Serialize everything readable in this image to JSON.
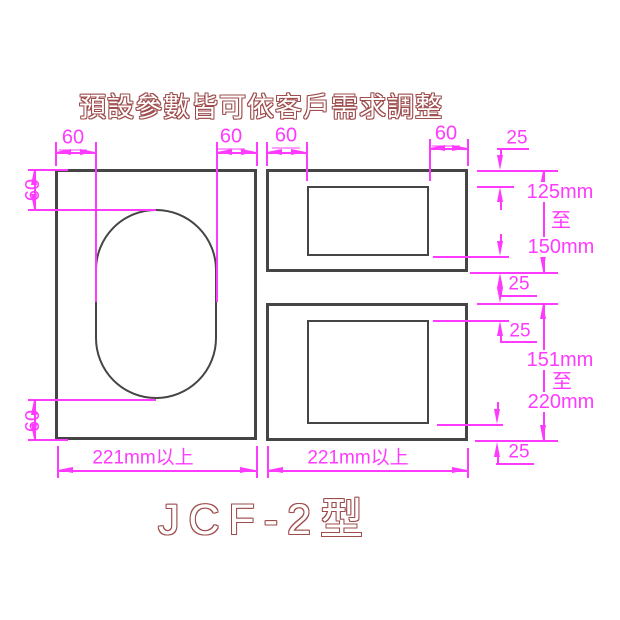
{
  "title": "預設參數皆可依客戶需求調整",
  "model": "JCF-2型",
  "colors": {
    "dimension": "#ff3aff",
    "label_outline": "#9e4c4c",
    "geometry": "#454545",
    "background": "#ffffff"
  },
  "dims": {
    "top1": "60",
    "top2": "60",
    "top3": "60",
    "top4": "60",
    "left_top": "60",
    "left_bottom": "60",
    "margin1": "25",
    "margin2": "25",
    "margin3": "25",
    "margin4": "25",
    "range1_min": "125mm",
    "range1_sep": "至",
    "range1_max": "150mm",
    "range2_min": "151mm",
    "range2_sep": "至",
    "range2_max": "220mm",
    "width_left": "221mm以上",
    "width_right": "221mm以上"
  }
}
